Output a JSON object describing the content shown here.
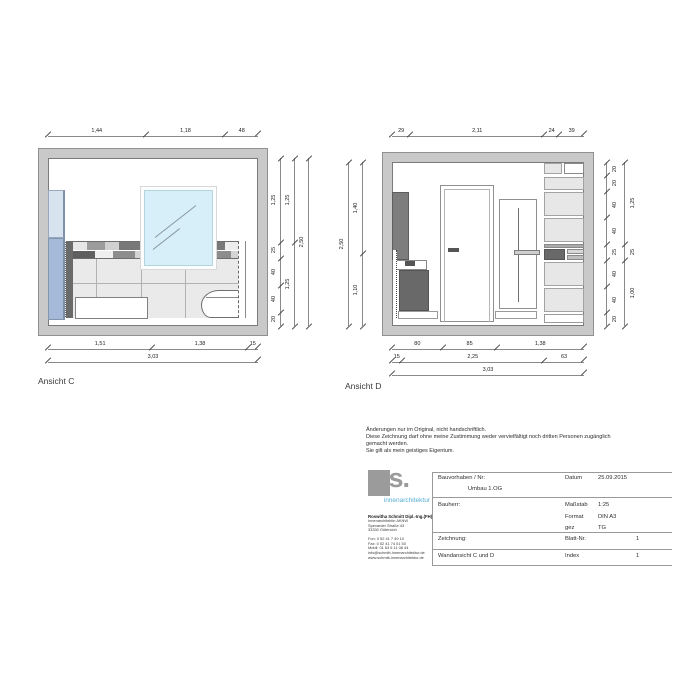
{
  "colors": {
    "wall": "#c9c9c9",
    "wall_border": "#909090",
    "line": "#8a8a8a",
    "tick": "#444444",
    "glass_top": "#d8e3f0",
    "glass_bottom": "#a5bad8",
    "glass_edge": "#7e90a8",
    "mirror_fill": "#d6eff8",
    "mirror_edge": "#b5d4e0",
    "tile": "#eaeaea",
    "grout": "#b2b2b2",
    "dark_fixture": "#6a6a6a",
    "cabinet_dark": "#7d7d7d",
    "shelf": "#e7e7e7",
    "shelf_band": "#ababab",
    "logo_gray": "#9b9b9b",
    "logo_blue": "#56aed2"
  },
  "ansicht_c": {
    "label": "Ansicht C",
    "dims_top": [
      "1,44",
      "1,18",
      "48"
    ],
    "dims_bottom": [
      "1,51",
      "1,38",
      "15"
    ],
    "dim_total": "3,03",
    "dims_right_inner": [
      "1,25",
      "25",
      "40",
      "40",
      "20"
    ],
    "dims_right_mid": [
      "1,25",
      "1,25"
    ],
    "dim_right_total": "2,50"
  },
  "ansicht_d": {
    "label": "Ansicht D",
    "dims_top": [
      "29",
      "2,11",
      "24",
      "39"
    ],
    "dims_bottom_row1": [
      "80",
      "85",
      "1,38"
    ],
    "dims_bottom_row2": [
      "15",
      "2,25",
      "63"
    ],
    "dim_total": "3,03",
    "dims_left_inner": [
      "1,40",
      "1,10"
    ],
    "dim_left_total": "2,50",
    "dims_right_inner": [
      "20",
      "20",
      "40",
      "40",
      "25",
      "40",
      "40",
      "20"
    ],
    "dims_right_outer": [
      "1,25",
      "25",
      "1,00"
    ]
  },
  "disclaimer": {
    "line1": "Änderungen nur im Original, nicht handschriftlich.",
    "line2": "Diese Zeichnung darf ohne meine Zustimmung weder vervielfältigt noch dritten Personen zugänglich",
    "line3": "gemacht werden.",
    "line4": "Sie gilt als mein geistiges Eigentum."
  },
  "title_block": {
    "logo_text": "rs.",
    "logo_subtitle": "innenarchitektur",
    "address_name": "Roswitha Schmitt Dipl.-Ing.(FH)",
    "address_line1": "Innenarchitektin AKNW",
    "address_line2": "Spexarder Straße 43",
    "address_line3": "33330 Gütersloh",
    "contact_line1": "Fon:  0 52 41 7 49 10",
    "contact_line2": "Fax:  0 52 41 74 01 50",
    "contact_line3": "Mobil: 01 63 6 11 08 44",
    "contact_line4": "info@schmitt-innenarchitektur.de",
    "contact_line5": "www.schmitt-innenarchitektur.de",
    "bauvorhaben_label": "Bauvorhaben / Nr:",
    "bauvorhaben_value": "Umbau 1.OG",
    "datum_label": "Datum",
    "datum_value": "25.09.2015",
    "bauherr_label": "Bauherr:",
    "massstab_label": "Maßstab",
    "massstab_value": "1:25",
    "format_label": "Format",
    "format_value": "DIN A3",
    "gez_label": "gez",
    "gez_value": "TG",
    "zeichnung_label": "Zeichnung:",
    "blattnr_label": "Blatt-Nr.",
    "blattnr_value": "1",
    "wandansicht_label": "Wandansicht C und D",
    "index_label": "Index",
    "index_value": "1"
  }
}
